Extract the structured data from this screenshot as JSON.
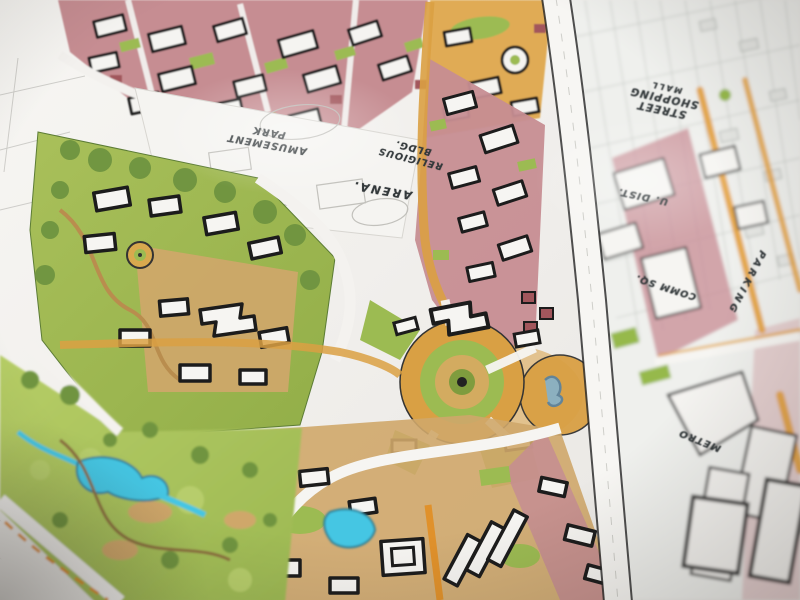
{
  "scene": {
    "title": "Hand-drawn urban master plan sketch",
    "medium": "marker and ink drawing on paper, photographed at an oblique angle with shallow depth of field"
  },
  "labels": {
    "amusement": {
      "line1": "AMUSEMENT",
      "line2": "PARK"
    },
    "religious": {
      "line1": "RELIGIOUS",
      "line2": "BLDG."
    },
    "arena": {
      "text": "ARENA."
    },
    "mall": {
      "line1": "STREET",
      "line2": "SHOPPING",
      "line3": "MALL"
    },
    "u_dist": {
      "text": "U. DIST."
    },
    "comm_sq": {
      "text": "COMM SQ."
    },
    "parking": {
      "text": "PARKING"
    },
    "metro": {
      "text": "METRO"
    }
  },
  "palette": {
    "paper": "#f3f1ee",
    "ink": "#23272a",
    "pen": "#33393b",
    "lawn": "#a7c058",
    "lawn_bright": "#b4cc62",
    "tree": "#6f9440",
    "pink": "#c68d92",
    "maroon": "#a2565c",
    "amber": "#daa043",
    "orange": "#e0912b",
    "buff": "#cfa76a",
    "water": "#45c6e3",
    "pencil": "#c2c1bc"
  },
  "features": [
    {
      "name": "north-residential-district",
      "fill": "pink",
      "detail": "white courtyard buildings with heavy ink outlines"
    },
    {
      "name": "northeast-campus-blocks",
      "fill": "amber",
      "detail": "oval lawn and round building"
    },
    {
      "name": "amusement-park-site",
      "fill": "white",
      "detail": "faint pencil layout only"
    },
    {
      "name": "arena-site",
      "fill": "white",
      "detail": "pencil oval footprint"
    },
    {
      "name": "central-plaza-roundabout",
      "fill": "amber/green",
      "detail": "concentric rings with radiating streets"
    },
    {
      "name": "fountain-plaza",
      "fill": "amber/blue",
      "detail": "sketched fountain"
    },
    {
      "name": "west-village-cluster",
      "fill": "green/tan",
      "detail": "cross-shaped building and mini roundabout"
    },
    {
      "name": "southwest-lakeside-park",
      "fill": "green/blue",
      "detail": "creek, two ponds, tree clumps"
    },
    {
      "name": "main-street-corridor",
      "fill": "white",
      "detail": "wide avenue separating sharp and blurred halves"
    },
    {
      "name": "east-shopping-mall-district",
      "fill": "white/pink",
      "detail": "out-of-focus fine city grid"
    },
    {
      "name": "east-parking-road",
      "fill": "amber"
    },
    {
      "name": "southeast-metro-blocks",
      "fill": "white",
      "detail": "bold outlined slabs"
    }
  ]
}
